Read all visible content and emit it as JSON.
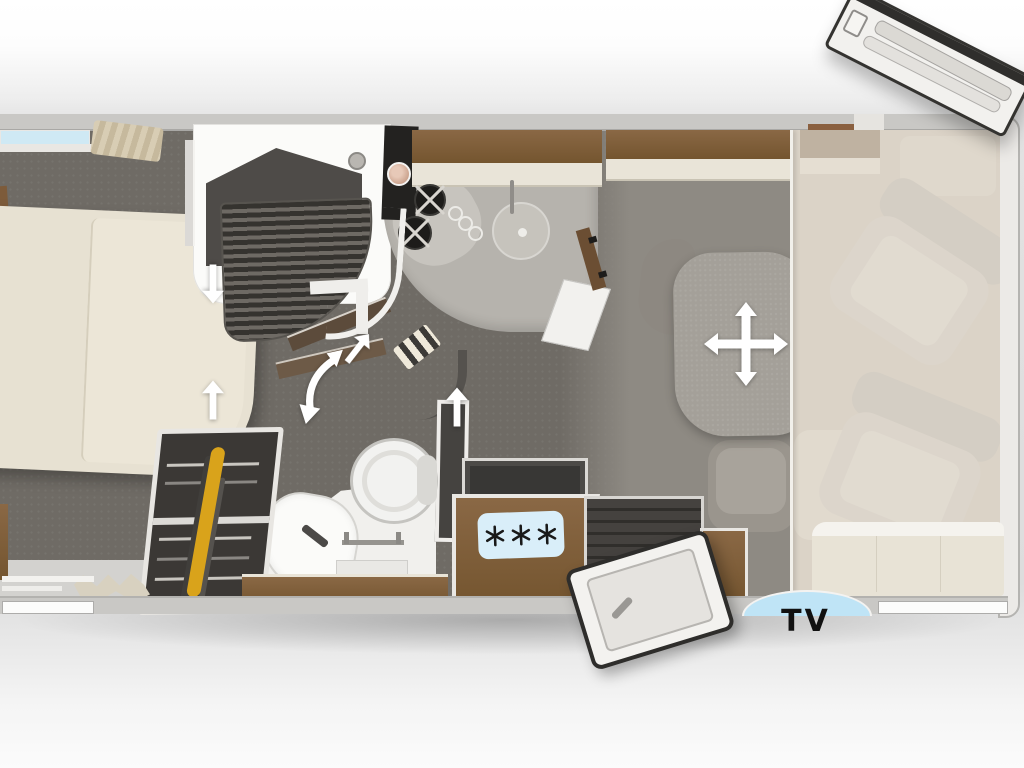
{
  "floorplan": {
    "kind": "motorhome floor plan, top view",
    "tv_label": "TV"
  },
  "icons": {
    "table_move": "four-way-move-arrow",
    "door_swing": "curved-double-arrow",
    "passage_bedroom_down": "down-arrow",
    "passage_bedroom_up": "up-arrow",
    "passage_kitchen_up": "up-arrow",
    "door_open_direction": "up-right-arrow",
    "fridge_badge": "three-snowflakes"
  },
  "colors": {
    "floor_dark": "#6f6b65",
    "floor_lounge": "#8e8a83",
    "cab_overlay": "#cbc3b5",
    "wood": "#7d5b3a",
    "bed_cream": "#e7e1d2",
    "window_blue": "#cfe9f4",
    "fridge_label_blue": "#d9eef9",
    "tv_window_blue": "#bfe4f6",
    "wall_grey": "#c9c8c5",
    "arrow_white": "#ffffff"
  },
  "furniture": [
    "bed",
    "shower",
    "wardrobe",
    "washbasin",
    "toilet",
    "kitchen hob",
    "sink",
    "refrigerator",
    "entry step",
    "entry door (open)",
    "roof door (open)",
    "table",
    "dinette seats",
    "bench sofa",
    "cab seat front",
    "cab seat rear",
    "tv cabinet",
    "overhead cabinets"
  ]
}
